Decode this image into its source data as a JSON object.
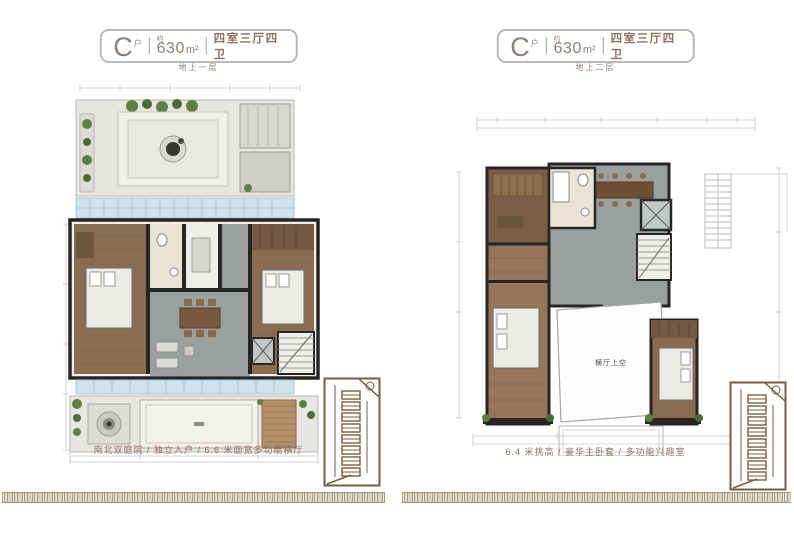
{
  "panels": [
    {
      "badge": {
        "letter": "C",
        "letter_suffix": "户",
        "approx": "约",
        "area": "630",
        "unit": "m²",
        "rooms": "四室三厅四卫"
      },
      "floor_label": "地上一层",
      "caption": "南北双庭院 / 独立入户 / 6.6 米面宽多功能横厅",
      "plan": {
        "void_label": ""
      }
    },
    {
      "badge": {
        "letter": "C",
        "letter_suffix": "户",
        "approx": "约",
        "area": "630",
        "unit": "m²",
        "rooms": "四室三厅四卫"
      },
      "floor_label": "地上二层",
      "caption": "6.4 米挑高 / 豪华主卧套 / 多功能兴趣室",
      "plan": {
        "void_label": "横厅上空"
      }
    }
  ],
  "colors": {
    "badge_border": "#bcb8b3",
    "badge_text": "#8a8078",
    "rooms_text": "#8d6f60",
    "caption_text": "#8d7265",
    "meander": "#a89b7d",
    "keymap_line": "#7d5b3a",
    "wall": "#262626",
    "wood_floor": "#8a6c51",
    "stone_floor": "#9aa09e",
    "glass": "#cfe3eb",
    "plant_green": "#5f7f42",
    "paving": "#e7e6e2"
  }
}
